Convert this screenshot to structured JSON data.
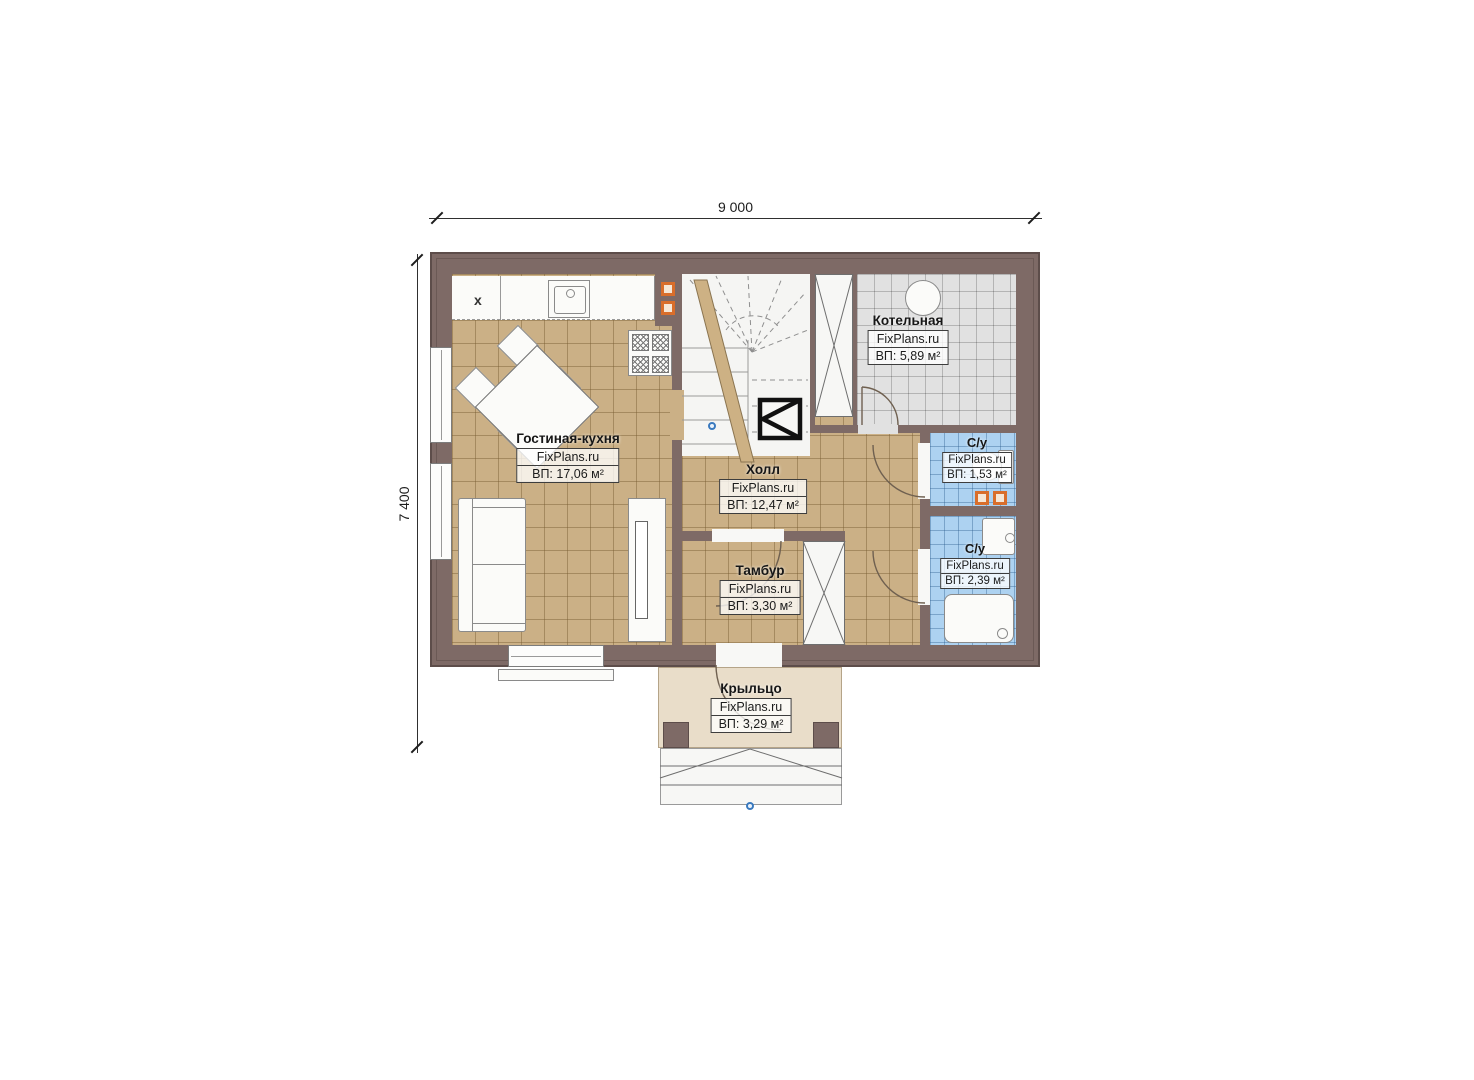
{
  "dimensions": {
    "horizontal": "9 000",
    "vertical": "7 400"
  },
  "rooms": {
    "living": {
      "name": "Гостиная-кухня",
      "brand": "FixPlans.ru",
      "area": "ВП: 17,06 м²"
    },
    "hall": {
      "name": "Холл",
      "brand": "FixPlans.ru",
      "area": "ВП: 12,47 м²"
    },
    "tambour": {
      "name": "Тамбур",
      "brand": "FixPlans.ru",
      "area": "ВП: 3,30 м²"
    },
    "boiler": {
      "name": "Котельная",
      "brand": "FixPlans.ru",
      "area": "ВП: 5,89 м²"
    },
    "bath1": {
      "name": "С/у",
      "brand": "FixPlans.ru",
      "area": "ВП: 1,53 м²"
    },
    "bath2": {
      "name": "С/у",
      "brand": "FixPlans.ru",
      "area": "ВП: 2,39 м²"
    },
    "porch": {
      "name": "Крыльцо",
      "brand": "FixPlans.ru",
      "area": "ВП: 3,29 м²"
    }
  },
  "markers": {
    "kitchen_mark": "x"
  },
  "colors": {
    "wall": "#7e6a66",
    "floor_tan": "#cbb086",
    "floor_gray": "#e1e1e1",
    "floor_blue": "#add2f1",
    "porch_slab": "#e9ddc9",
    "vent_orange": "#d96e2b",
    "marker_blue": "#3a7abf"
  }
}
